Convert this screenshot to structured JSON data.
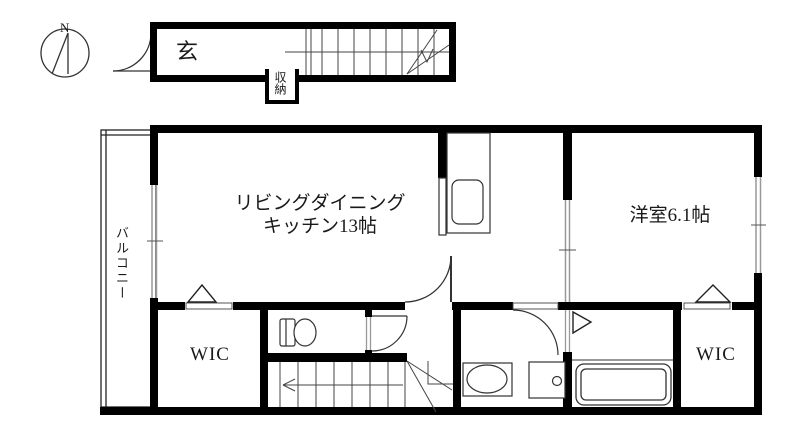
{
  "compass": {
    "north_label": "N"
  },
  "labels": {
    "entrance": "玄",
    "storage": "収納",
    "balcony": "バルコニー",
    "ldk_line1": "リビングダイニング",
    "ldk_line2": "キッチン13帖",
    "western_room": "洋室6.1帖",
    "wic_left": "WIC",
    "wic_right": "WIC"
  },
  "colors": {
    "wall": "#000000",
    "fixture": "#333333",
    "window": "#999999",
    "background": "#ffffff"
  }
}
